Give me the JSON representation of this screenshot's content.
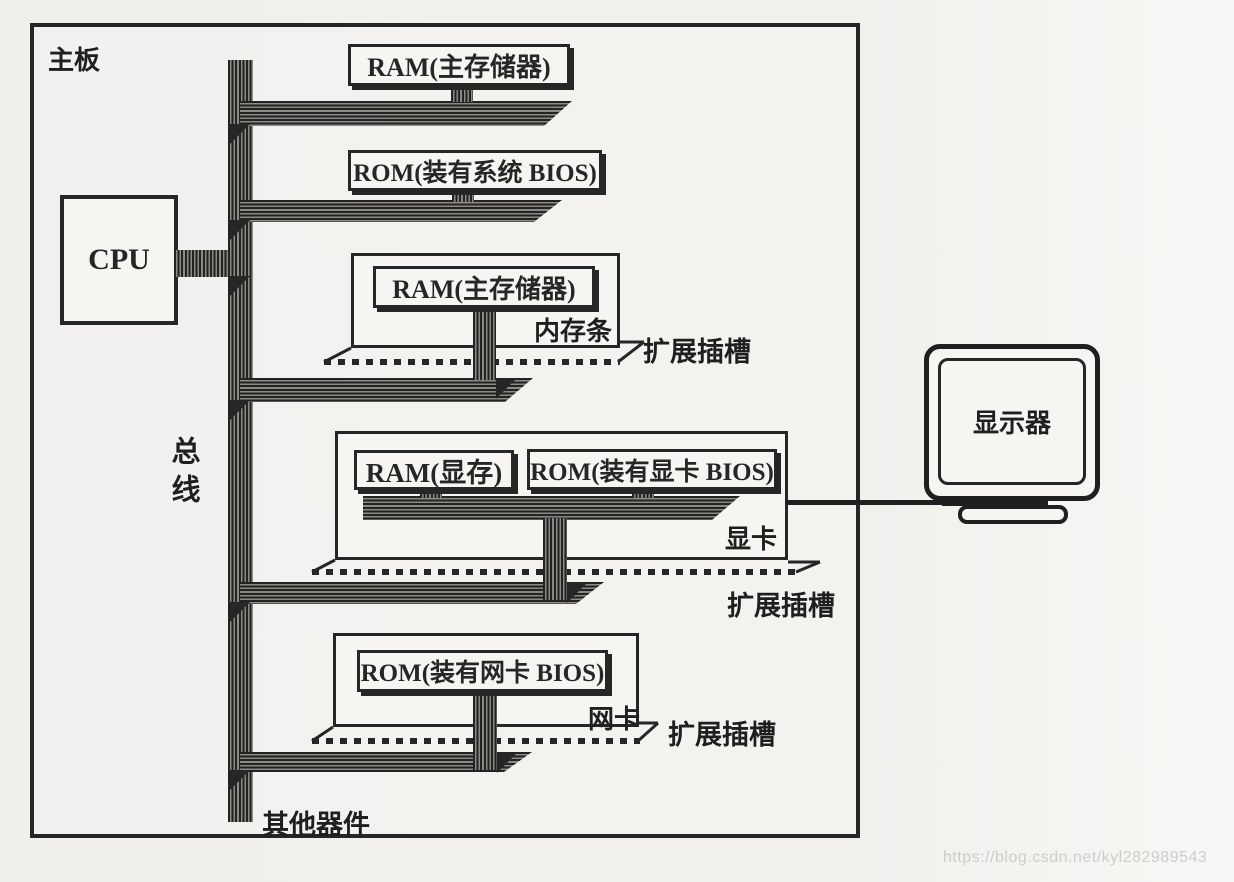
{
  "board": {
    "label": "主板"
  },
  "cpu": {
    "label": "CPU"
  },
  "bus": {
    "label": "总线"
  },
  "ram_main": {
    "label": "RAM(主存储器)"
  },
  "rom_system": {
    "label": "ROM(装有系统 BIOS)"
  },
  "memory_stick": {
    "chip": "RAM(主存储器)",
    "name": "内存条",
    "slot": "扩展插槽"
  },
  "graphics_card": {
    "ram": "RAM(显存)",
    "rom": "ROM(装有显卡 BIOS)",
    "name": "显卡",
    "slot": "扩展插槽"
  },
  "network_card": {
    "rom": "ROM(装有网卡 BIOS)",
    "name": "网卡",
    "slot": "扩展插槽"
  },
  "other_devices": {
    "label": "其他器件"
  },
  "monitor": {
    "label": "显示器"
  },
  "watermark": {
    "text": "https://blog.csdn.net/kyl282989543"
  },
  "colors": {
    "ink": "#262626",
    "paper": "#f3f1ee",
    "band_dark": "#232323",
    "band_light": "#8d8983",
    "watermark": "#d8d5d2"
  }
}
